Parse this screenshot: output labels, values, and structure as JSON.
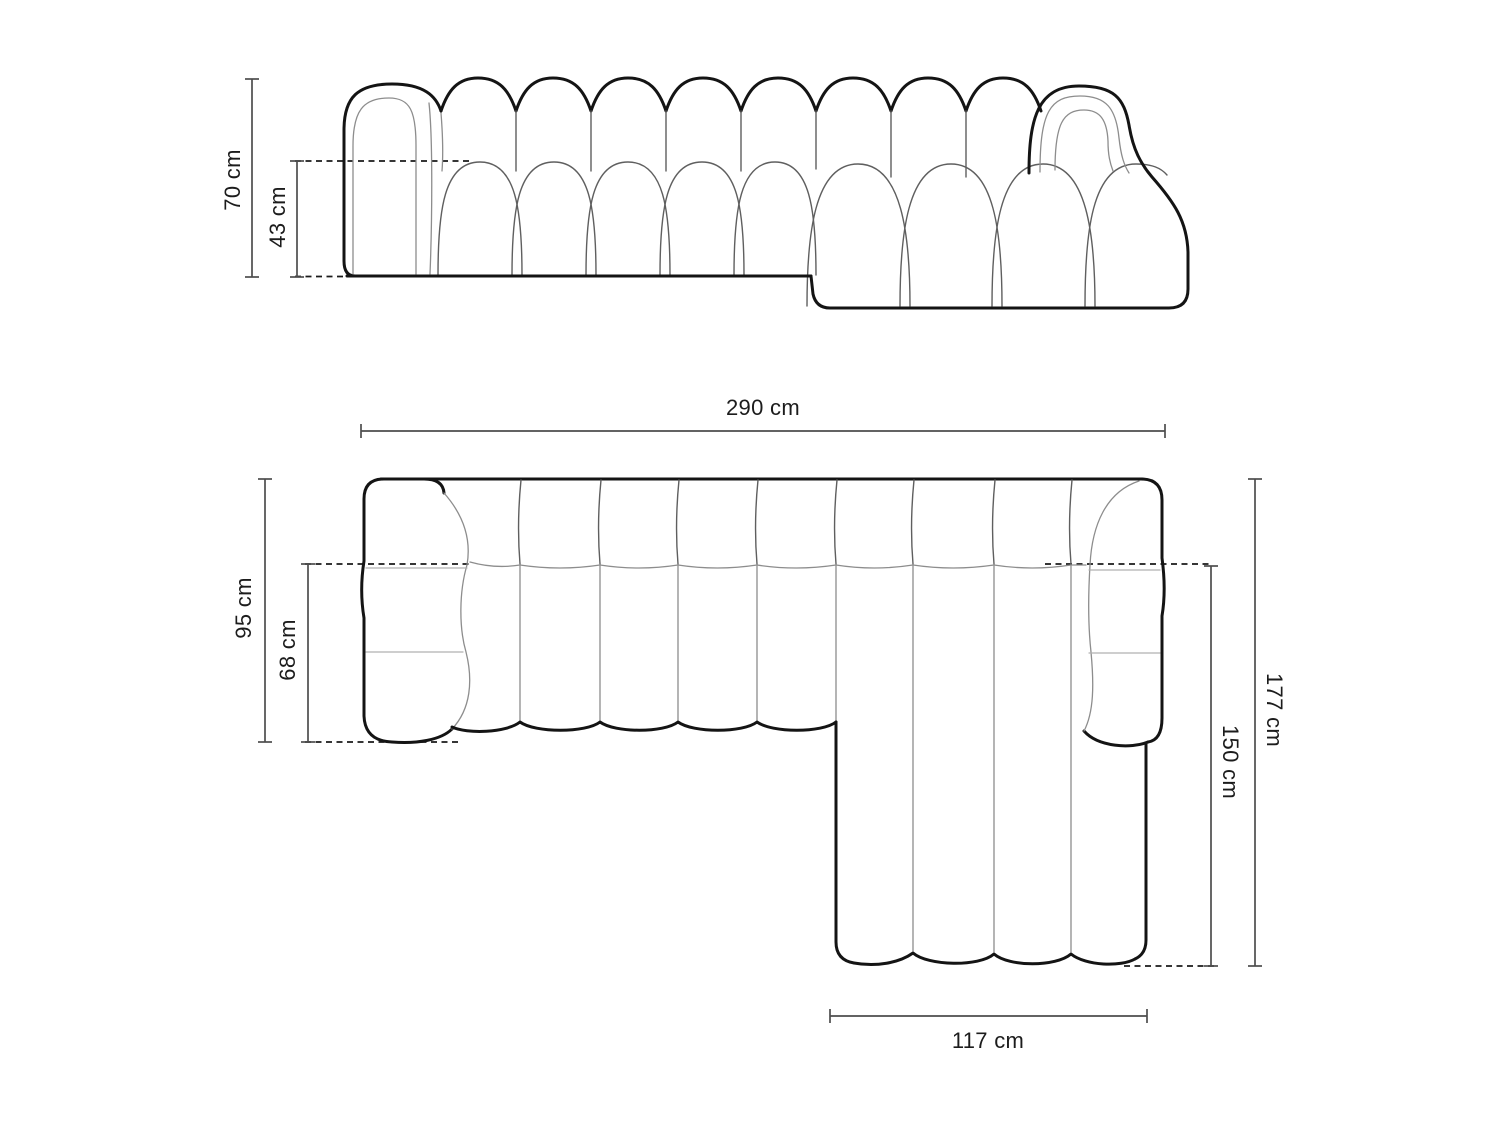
{
  "document": {
    "type": "furniture-dimension-diagram",
    "subject": "left-corner modular chaise sofa, channel tufted",
    "views": [
      "front elevation",
      "top plan"
    ]
  },
  "front_view": {
    "dims": {
      "total_height": "70 cm",
      "seat_height": "43 cm"
    }
  },
  "top_view": {
    "dims": {
      "total_width": "290 cm",
      "total_depth": "95 cm",
      "seat_depth": "68 cm",
      "chaise_side_depth": "177 cm",
      "chaise_length": "150 cm",
      "chaise_width": "117 cm"
    }
  },
  "style": {
    "background": "#ffffff",
    "outline_color": "#141414",
    "inner_line_color": "#8d8d8d",
    "dimension_line_color": "#4d4d4d",
    "text_color": "#1c1c1c"
  }
}
